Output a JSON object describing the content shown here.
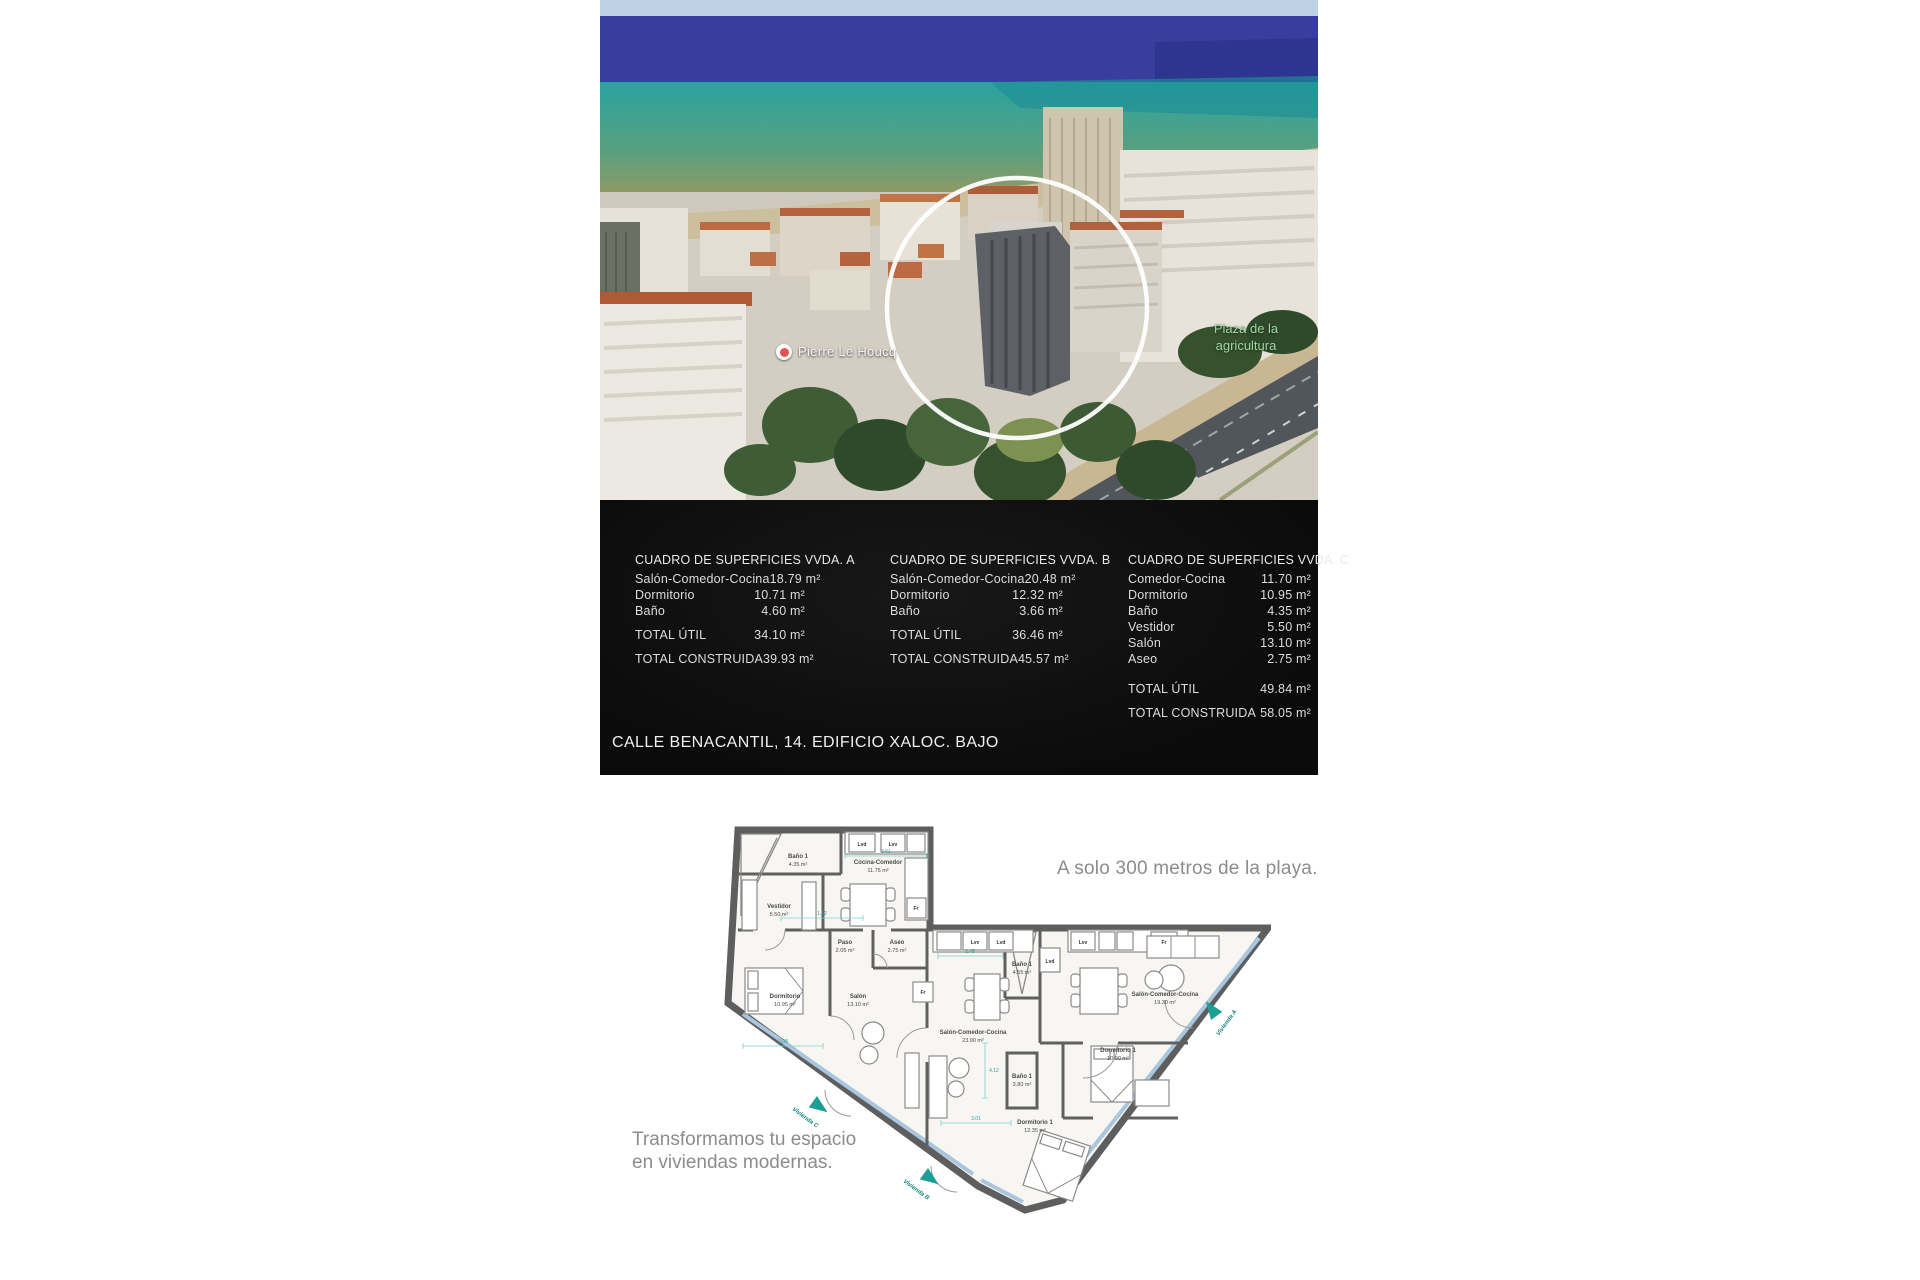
{
  "photo": {
    "place_label": "Pierre Le Houcq",
    "park_label_line1": "Plaza de la",
    "park_label_line2": "agricultura"
  },
  "surfaces": {
    "address": "CALLE BENACANTIL, 14. EDIFICIO XALOC. BAJO",
    "tables": [
      {
        "title": "CUADRO DE SUPERFICIES VVDA. A",
        "rows": [
          {
            "label": "Salón-Comedor-Cocina",
            "value": "18.79 m²"
          },
          {
            "label": "Dormitorio",
            "value": "10.71 m²"
          },
          {
            "label": "Baño",
            "value": "4.60 m²"
          }
        ],
        "total_util": {
          "label": "TOTAL ÚTIL",
          "value": "34.10 m²"
        },
        "total_built": {
          "label": "TOTAL CONSTRUIDA",
          "value": "39.93 m²"
        }
      },
      {
        "title": "CUADRO DE SUPERFICIES VVDA. B",
        "rows": [
          {
            "label": "Salón-Comedor-Cocina",
            "value": "20.48 m²"
          },
          {
            "label": "Dormitorio",
            "value": "12.32 m²"
          },
          {
            "label": "Baño",
            "value": "3.66 m²"
          }
        ],
        "total_util": {
          "label": "TOTAL ÚTIL",
          "value": "36.46 m²"
        },
        "total_built": {
          "label": "TOTAL CONSTRUIDA",
          "value": "45.57 m²"
        }
      },
      {
        "title": "CUADRO DE SUPERFICIES VVDA. C",
        "rows": [
          {
            "label": "Comedor-Cocina",
            "value": "11.70 m²"
          },
          {
            "label": "Dormitorio",
            "value": "10.95 m²"
          },
          {
            "label": "Baño",
            "value": "4.35 m²"
          },
          {
            "label": "Vestidor",
            "value": "5.50 m²"
          },
          {
            "label": "Salón",
            "value": "13.10 m²"
          },
          {
            "label": "Aseo",
            "value": "2.75 m²"
          }
        ],
        "total_util": {
          "label": "TOTAL ÚTIL",
          "value": "49.84 m²"
        },
        "total_built": {
          "label": "TOTAL CONSTRUIDA",
          "value": "58.05 m²"
        }
      }
    ]
  },
  "plan": {
    "headline": "A solo 300 metros de la playa.",
    "tagline_line1": "Transformamos tu espacio",
    "tagline_line2": "en viviendas modernas.",
    "rooms": [
      {
        "name": "Baño 1",
        "area": "4.35 m²"
      },
      {
        "name": "Cocina-Comedor",
        "area": "11.75 m²"
      },
      {
        "name": "Vestidor",
        "area": "5.50 m²"
      },
      {
        "name": "Paso",
        "area": "2.05 m²"
      },
      {
        "name": "Aseo",
        "area": "2.75 m²"
      },
      {
        "name": "Dormitorio",
        "area": "10.95 m²"
      },
      {
        "name": "Salón",
        "area": "13.10 m²"
      },
      {
        "name": "Baño 1",
        "area": "4.55 m²"
      },
      {
        "name": "Salón-Comedor-Cocina",
        "area": "23.90 m²"
      },
      {
        "name": "Baño 1",
        "area": "3.80 m²"
      },
      {
        "name": "Dormitorio 1",
        "area": "10.90 m²"
      },
      {
        "name": "Salón-Comedor-Cocina",
        "area": "19.30 m²"
      },
      {
        "name": "Dormitorio 1",
        "area": "12.35 m²"
      }
    ],
    "appliances": [
      "Lvd",
      "Lvv",
      "Fr",
      "Lvv",
      "Lvd",
      "Lvd",
      "Fr",
      "Lvv",
      "Fr"
    ],
    "entrances": [
      "Vivienda C",
      "Vivienda B",
      "Vivienda A"
    ],
    "dimensions": [
      "3.61",
      "1.52",
      "2.45",
      "2.08",
      "3.01",
      "4.12"
    ]
  },
  "colors": {
    "panel_bg": "#0e0e0e",
    "accent_teal": "#13857d",
    "dim_teal": "#7fcfcf",
    "sea_deep": "#383d9e",
    "sea_teal": "#2aa3a0",
    "sand": "#ccbf9d",
    "sky": "#bdd3e5"
  }
}
